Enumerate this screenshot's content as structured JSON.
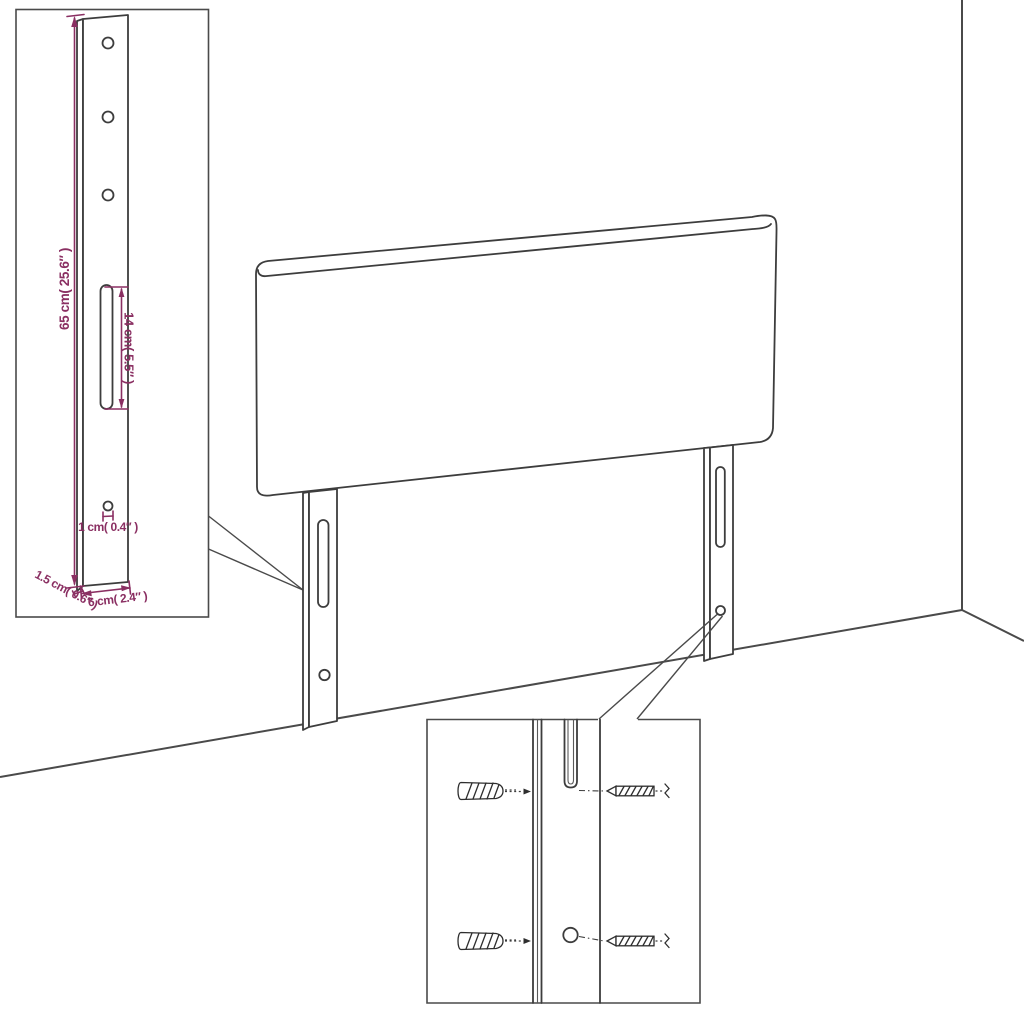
{
  "colors": {
    "background": "#ffffff",
    "line_art": "#3d3d3d",
    "dimension_accent": "#8a2f62"
  },
  "dimension_labels": {
    "bracket_height": "65 cm( 25.6″ )",
    "slot_length": "14 cm( 5.5″ )",
    "hole_diameter": "1 cm( 0.4″ )",
    "bracket_thickness": "1.5 cm( 0.6″ )",
    "bracket_width": "6 cm( 2.4″ )"
  }
}
